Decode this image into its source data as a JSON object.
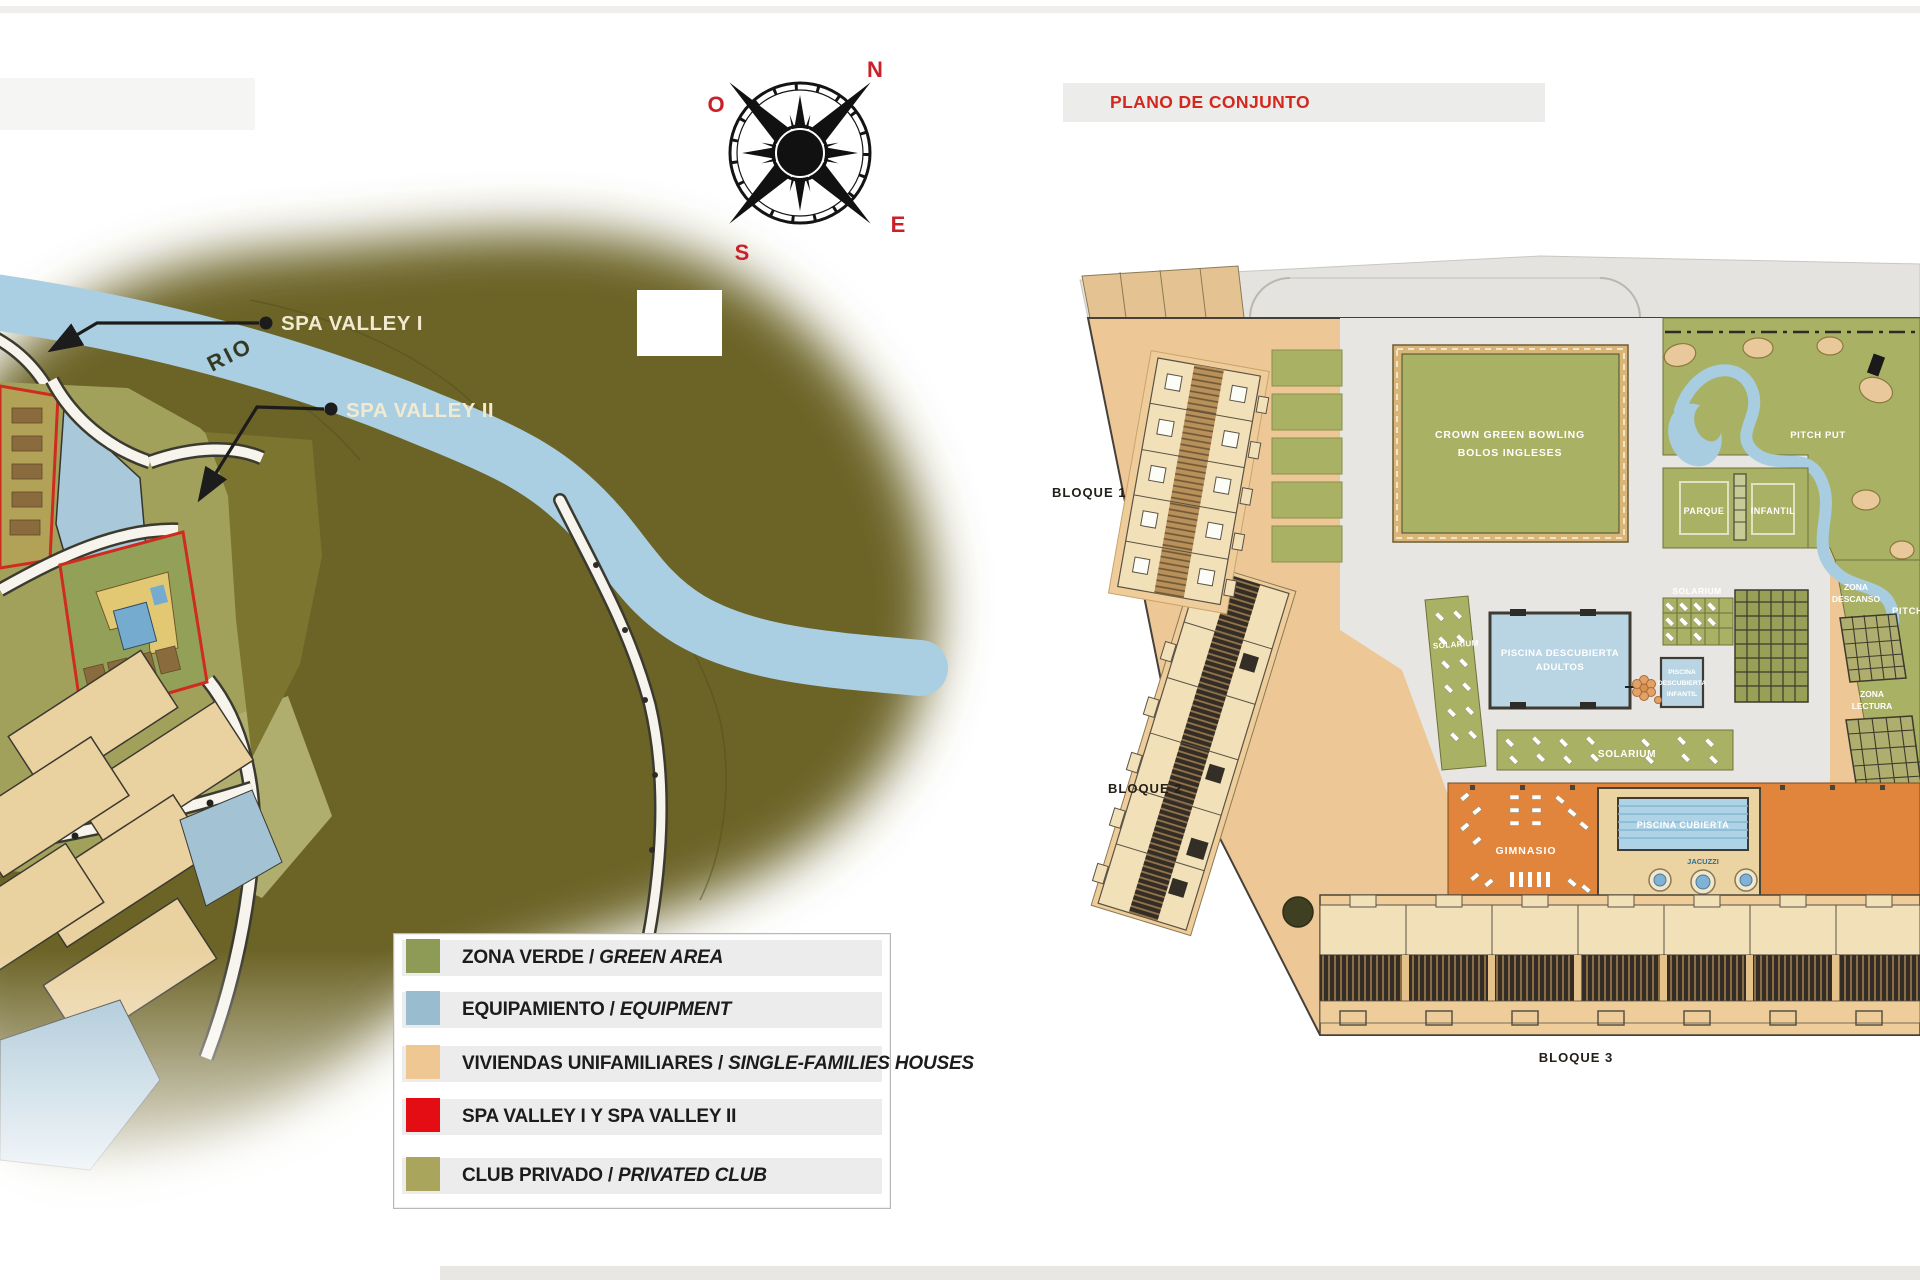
{
  "left_map": {
    "compass": {
      "north": "N",
      "south": "S",
      "east": "E",
      "west": "O"
    },
    "compass_letter_color": "#c9202a",
    "river_label": "RIO",
    "river_color": "#abcfe2",
    "callout_spa1": "SPA VALLEY I",
    "callout_spa2": "SPA VALLEY II",
    "legend_items": [
      {
        "es": "ZONA VERDE / ",
        "en": "GREEN AREA",
        "color": "#8d9b56"
      },
      {
        "es": "EQUIPAMIENTO / ",
        "en": "EQUIPMENT",
        "color": "#9abccf"
      },
      {
        "es": "VIVIENDAS UNIFAMILIARES / ",
        "en": "SINGLE-FAMILIES HOUSES",
        "color": "#eec793"
      },
      {
        "es": "SPA VALLEY I Y SPA VALLEY II",
        "en": "",
        "color": "#e30d13"
      },
      {
        "es": "CLUB PRIVADO / ",
        "en": "PRIVATED CLUB",
        "color": "#a9a55d"
      }
    ]
  },
  "site_plan": {
    "title": "PLANO DE CONJUNTO",
    "title_color": "#d3281e",
    "labels": {
      "bloque1": "BLOQUE 1",
      "bloque2": "BLOQUE 2",
      "bloque3": "BLOQUE 3",
      "crown1": "CROWN GREEN BOWLING",
      "crown2": "BOLOS INGLESES",
      "pitch_put_a": "PITCH PUT",
      "pitch_put_b": "PITCH PUT",
      "parque1": "PARQUE",
      "parque2": "INFANTIL",
      "solarium_a": "SOLARIUM",
      "solarium_b": "SOLARIUM",
      "solarium_c": "SOLARIUM",
      "zona_descanso1": "ZONA",
      "zona_descanso2": "DESCANSO",
      "zona_lectura1": "ZONA",
      "zona_lectura2": "LECTURA",
      "piscina_adultos1": "PISCINA DESCUBIERTA",
      "piscina_adultos2": "ADULTOS",
      "piscina_infantil1": "PISCINA",
      "piscina_infantil2": "DESCUBIERTA",
      "piscina_infantil3": "INFANTIL",
      "gimnasio": "GIMNASIO",
      "piscina_cubierta": "PISCINA CUBIERTA",
      "jacuzzi": "JACUZZI"
    }
  }
}
